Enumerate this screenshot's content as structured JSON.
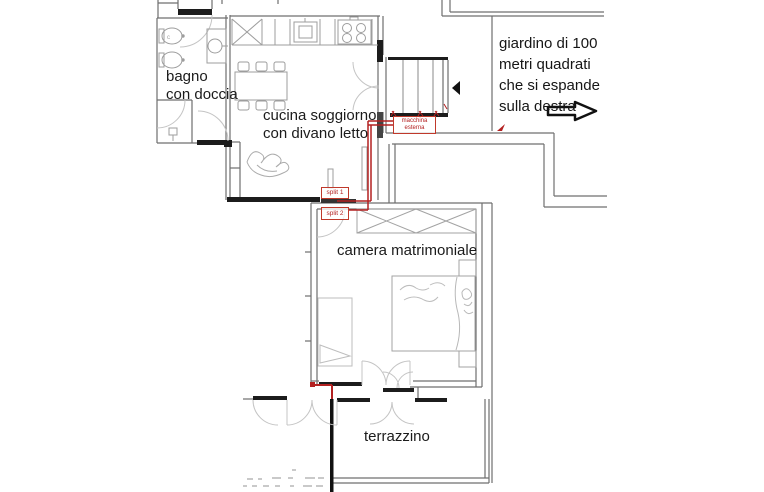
{
  "rooms": {
    "bathroom": {
      "line1": "bagno",
      "line2": "con doccia"
    },
    "kitchen_living": {
      "line1": "cucina soggiorno",
      "line2": "con divano letto"
    },
    "bedroom": {
      "label": "camera matrimoniale"
    },
    "terrace": {
      "label": "terrazzino"
    }
  },
  "garden_note": {
    "lines": [
      "giardino di 100",
      "metri quadrati",
      "che si espande",
      "sulla destra"
    ]
  },
  "ac_annotations": {
    "outdoor_unit_line1": "macchina",
    "outdoor_unit_line2": "esterna",
    "split1": "split 1",
    "split2": "split 2"
  },
  "colors": {
    "annotation_red": "#b32121",
    "wall_gray": "#6f6f6f",
    "wall_dark": "#1c1c1c",
    "door_arc_gray": "#c4c4c4",
    "furniture_gray": "#a3a3a3"
  }
}
